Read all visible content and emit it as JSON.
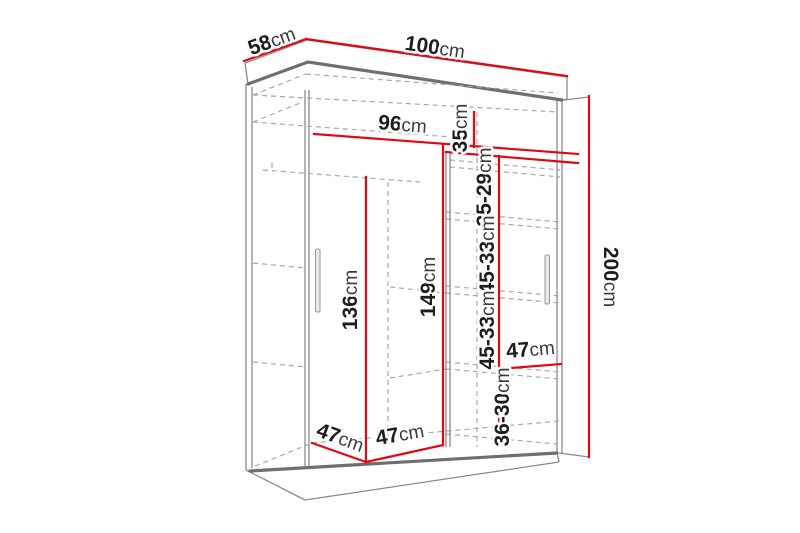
{
  "diagram": {
    "kind": "wardrobe dimension drawing",
    "unit": "cm",
    "colors": {
      "dimension_line": "#e30613",
      "outline": "#8a8a8a",
      "outline_dark": "#6f6f6f",
      "dashed": "#a8a8a8",
      "text": "#1d1d1b"
    },
    "dimensions": {
      "depth": {
        "value": "58",
        "unit": "cm"
      },
      "width": {
        "value": "100",
        "unit": "cm"
      },
      "height": {
        "value": "200",
        "unit": "cm"
      },
      "interior_width": {
        "value": "96",
        "unit": "cm"
      },
      "top_shelf": {
        "value": "35",
        "unit": "cm"
      },
      "gap1": {
        "value": "35-29",
        "unit": "cm"
      },
      "gap2": {
        "value": "45-33",
        "unit": "cm"
      },
      "gap3": {
        "value": "45-33",
        "unit": "cm"
      },
      "gap4": {
        "value": "36-30",
        "unit": "cm"
      },
      "shelf_width": {
        "value": "47",
        "unit": "cm"
      },
      "left_height": {
        "value": "136",
        "unit": "cm"
      },
      "mid_height": {
        "value": "149",
        "unit": "cm"
      },
      "bottom_left": {
        "value": "47",
        "unit": "cm"
      },
      "bottom_mid": {
        "value": "47",
        "unit": "cm"
      }
    }
  }
}
